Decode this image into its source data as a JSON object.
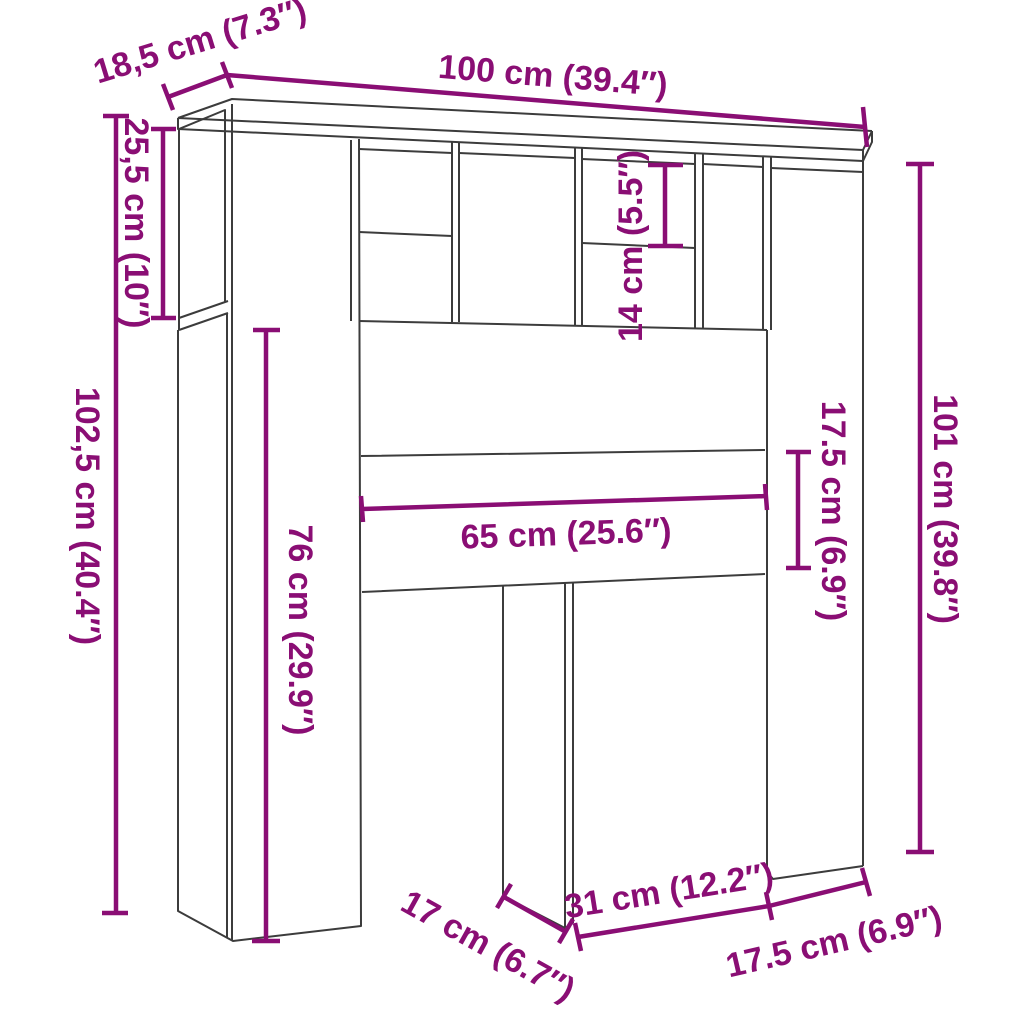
{
  "diagram": {
    "type": "furniture-dimension-diagram",
    "subject": "headboard-cabinet-with-storage",
    "background_color": "#ffffff",
    "outline_color": "#3c3c3c",
    "accent_color": "#8a0e74",
    "dimensions": [
      {
        "id": "top-depth",
        "label": "18,5 cm (7.3″)",
        "value_cm": "18,5",
        "value_in": "7.3"
      },
      {
        "id": "top-width",
        "label": "100 cm (39.4″)",
        "value_cm": "100",
        "value_in": "39.4"
      },
      {
        "id": "upper-left-height",
        "label": "25,5 cm (10″)",
        "value_cm": "25,5",
        "value_in": "10"
      },
      {
        "id": "overall-height-left",
        "label": "102,5 cm (40.4″)",
        "value_cm": "102,5",
        "value_in": "40.4"
      },
      {
        "id": "left-opening-height",
        "label": "76 cm (29.9″)",
        "value_cm": "76",
        "value_in": "29.9"
      },
      {
        "id": "top-cubby-height",
        "label": "14 cm (5.5″)",
        "value_cm": "14",
        "value_in": "5.5"
      },
      {
        "id": "middle-opening-width",
        "label": "65 cm (25.6″)",
        "value_cm": "65",
        "value_in": "25.6"
      },
      {
        "id": "rail-height",
        "label": "17.5 cm (6.9″)",
        "value_cm": "17.5",
        "value_in": "6.9"
      },
      {
        "id": "overall-height-right",
        "label": "101 cm (39.8″)",
        "value_cm": "101",
        "value_in": "39.8"
      },
      {
        "id": "leg-depth",
        "label": "17 cm (6.7″)",
        "value_cm": "17",
        "value_in": "6.7"
      },
      {
        "id": "bottom-gap-width",
        "label": "31 cm (12.2″)",
        "value_cm": "31",
        "value_in": "12.2"
      },
      {
        "id": "right-leg-width",
        "label": "17.5 cm (6.9″)",
        "value_cm": "17.5",
        "value_in": "6.9"
      }
    ]
  }
}
